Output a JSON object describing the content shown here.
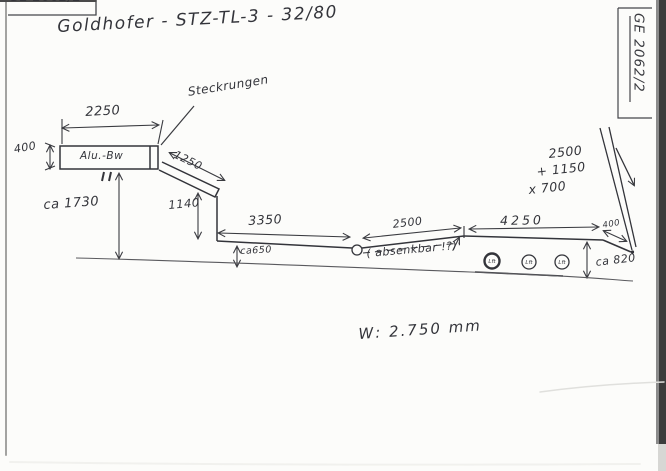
{
  "document": {
    "stamp_top_left": "GE 2062/2",
    "stamp_top_right": "GE 2062/2",
    "title": "Goldhofer - STZ-TL-3 - 32/80",
    "width_note": "W: 2.750 mm"
  },
  "labels": {
    "steckrungen": "Steckrungen",
    "gooseneck_body": "Alu.-Bw",
    "absenkbar_note": "( absenkbar !?)"
  },
  "dimensions": {
    "gooseneck_length": "2250",
    "gooseneck_height": "400",
    "gooseneck_deck_height": "ca 1730",
    "slope_length": "1250",
    "drop_height": "1140",
    "lowdeck_length": "3350",
    "lowdeck_height": "ca650",
    "mid_section_length": "2500",
    "axle_section_length": "4250",
    "tail_length": "400",
    "tail_height": "ca 820"
  },
  "ramp_note": {
    "line1": "2500",
    "line2": "+ 1150",
    "line3": "x 700"
  },
  "wheels": [
    {
      "label": "Lft"
    },
    {
      "label": "Lft"
    },
    {
      "label": "Lft"
    }
  ]
}
